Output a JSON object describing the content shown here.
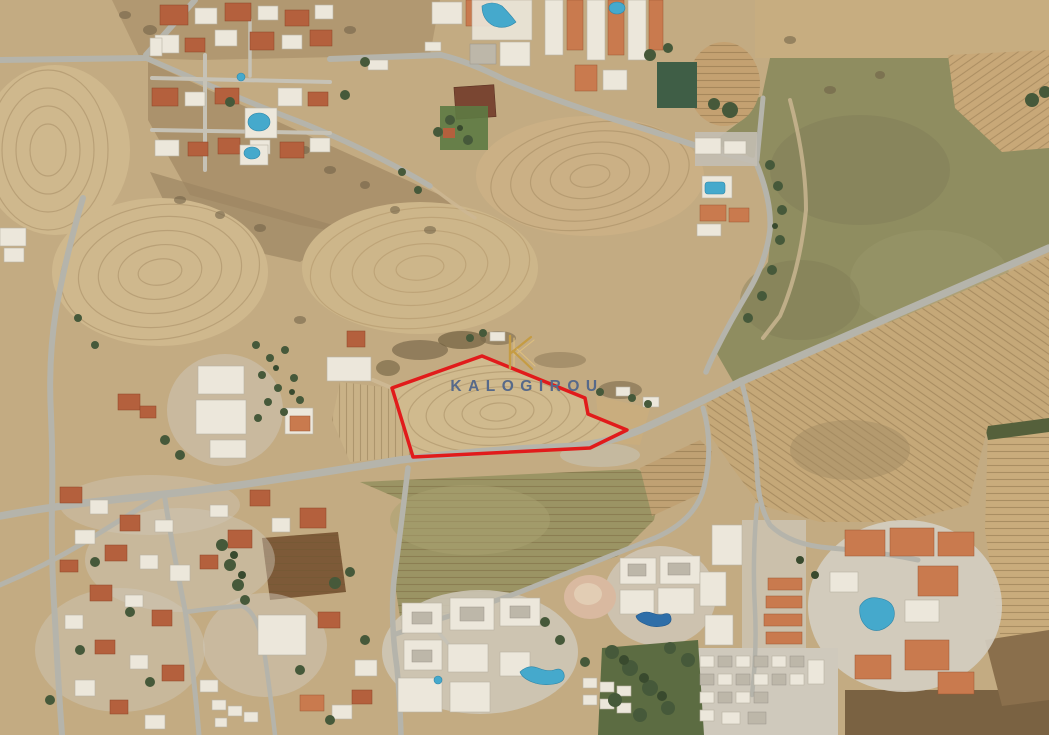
{
  "map_annotations": {
    "watermark": {
      "text": "KALOGIROU",
      "text_color": "#56698a",
      "logo_letter": "K",
      "logo_color": "#c59c43",
      "logo_color_light": "#debf7e"
    },
    "plot_outline": {
      "color": "#e11b1b",
      "stroke_width": 3.5,
      "points": "482,356 585,398 588,414 627,430 590,448 413,457 392,388"
    }
  },
  "scene": {
    "view": "satellite-aerial",
    "terrain_colors": {
      "field_tan": "#c3ab82",
      "field_green": "#8f8d60",
      "road_gray": "#b5b4ab",
      "tree_green": "#46593a",
      "pool_blue": "#45a9cc"
    }
  }
}
